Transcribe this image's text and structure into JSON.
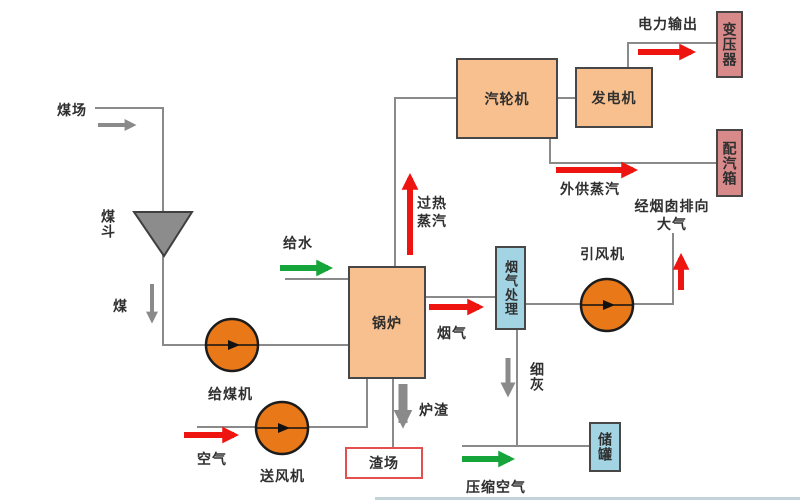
{
  "diagram": {
    "title_hint": "coal-fired power plant process flow diagram",
    "labels": {
      "coal_yard": "煤场",
      "coal_hopper": "煤斗",
      "coal": "煤",
      "coal_feeder": "给煤机",
      "air": "空气",
      "forced_draft_fan": "送风机",
      "feed_water": "给水",
      "boiler": "锅炉",
      "superheated_steam_line1": "过热",
      "superheated_steam_line2": "蒸汽",
      "steam_turbine": "汽轮机",
      "generator": "发电机",
      "power_output": "电力输出",
      "transformer": "变压器",
      "steam_distribution_box": "配汽箱",
      "external_steam": "外供蒸汽",
      "stack_line1": "经烟囱排向",
      "stack_line2": "大气",
      "induced_draft_fan": "引风机",
      "flue_gas": "烟气",
      "flue_gas_treatment": "烟气处理",
      "fine_ash": "细灰",
      "slag": "炉渣",
      "slag_yard": "渣场",
      "storage_tank": "储罐",
      "compressed_air": "压缩空气"
    },
    "colors": {
      "process_box_fill": "#f7c08e",
      "electric_box_fill": "#d8898a",
      "treatment_box_fill": "#a2d4e4",
      "fan_circle_fill": "#e87818",
      "slag_yard_border": "#e3504f",
      "arrow_red": "#ee1511",
      "arrow_green": "#16a53a",
      "arrow_gray": "#8a8a8a",
      "pipe_gray": "#8a8a8a",
      "hopper_gray": "#8c8c8c",
      "text_dark": "#2f2f2f"
    }
  }
}
